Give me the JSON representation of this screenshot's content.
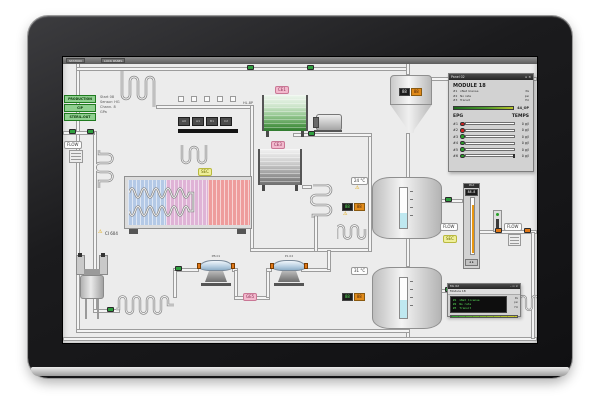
{
  "window": {
    "titlebar_left": "STATION",
    "titlebar_right": "LOCK PANEL"
  },
  "mode_panel": {
    "buttons": [
      "PRODUCTION",
      "CIP",
      "STERIL.OUT"
    ],
    "info_lines": [
      "Start 08",
      "Sensor: HG",
      "Chann. 8",
      "GPa"
    ]
  },
  "io_buttons": [
    "A0",
    "A1",
    "B1",
    "C2"
  ],
  "labels": {
    "flow": "FLOW",
    "sec": "SEC",
    "ce1": "CE1",
    "ce3": "CE3",
    "ge5": "GE5",
    "ci604": "CI 604",
    "hl": "HL.8P",
    "warning": "⚠",
    "tank1_temp": "24 °C",
    "tank2_temp": "31 °C",
    "pump1": "PB.01",
    "pump2": "P1.02"
  },
  "displays": {
    "funnel_left": "88",
    "funnel_right": "88",
    "tank1_left": "88",
    "tank1_right": "88",
    "tank2_left": "88",
    "tank2_right": "88",
    "gauge_title": "MAX",
    "gauge_value": "88.8",
    "gauge_buttons": "◂ ▸"
  },
  "panel02": {
    "title": "Panel 02",
    "window_buttons": "▫ ×",
    "heading": "MODULE 18",
    "info_rows": [
      {
        "id": "#1",
        "name": "xNet license",
        "unit": "Pa"
      },
      {
        "id": "#2",
        "name": "No rate",
        "unit": "psi"
      },
      {
        "id": "#3",
        "name": "Transit",
        "unit": "Hz"
      }
    ],
    "bar_label": "44_OP",
    "epg_header": "EPG",
    "temps_header": "TEMPS",
    "epg_rows": [
      {
        "id": "#1",
        "status": "red",
        "fill": 60,
        "value": "0 g/l"
      },
      {
        "id": "#2",
        "status": "red",
        "fill": 65,
        "value": "0 g/l"
      },
      {
        "id": "#3",
        "status": "green",
        "fill": 55,
        "value": "0 g/l"
      },
      {
        "id": "#4",
        "status": "green",
        "fill": 60,
        "value": "0 g/l"
      },
      {
        "id": "#5",
        "status": "green",
        "fill": 50,
        "value": "0 g/l"
      },
      {
        "id": "#6",
        "status": "green",
        "fill": 0,
        "value": "0 g/l"
      }
    ]
  },
  "ml_panel": {
    "title": "ML 02",
    "window_buttons": "– ▫ ×",
    "subtitle": "Module 18",
    "rows": [
      {
        "id": "#1",
        "name": "xNet license",
        "unit": "Pa"
      },
      {
        "id": "#2",
        "name": "No rate",
        "unit": "psi"
      },
      {
        "id": "#3",
        "name": "Transit",
        "unit": "Hz"
      }
    ]
  },
  "colors": {
    "valve_green": "#2e9e3e",
    "valve_orange": "#e07818",
    "alarm_red": "#d42020",
    "ok_green": "#28a028",
    "level_cyan": "#bfe8f0",
    "gauge_orange": "#e8960f",
    "accent_pink": "#f2b9cd",
    "accent_yellow": "#efef9a"
  }
}
